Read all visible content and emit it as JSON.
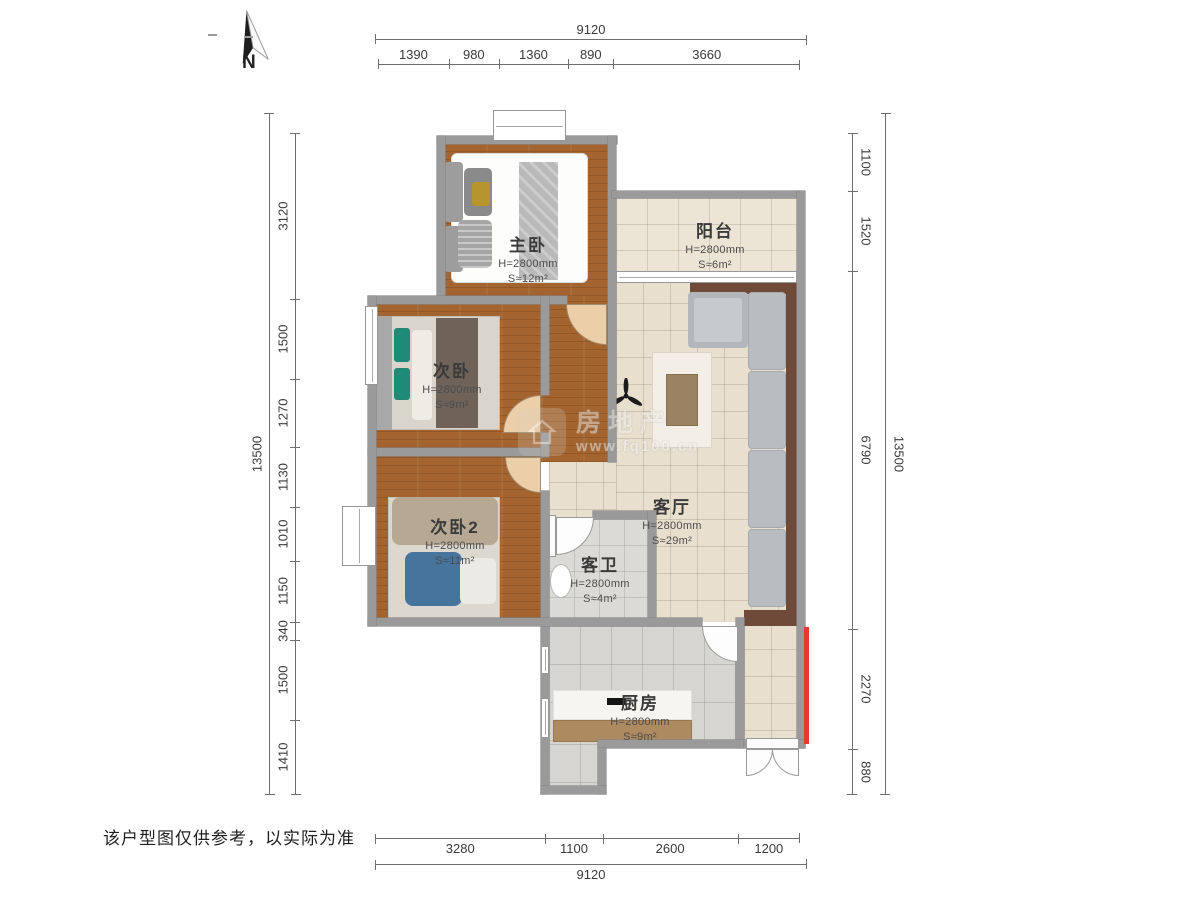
{
  "north": {
    "label": "N"
  },
  "disclaimer": "该户型图仅供参考，以实际为准",
  "watermark": {
    "brand": "房地产",
    "url": "www.fq100.cn",
    "icon": "house-icon"
  },
  "rooms": {
    "master": {
      "name": "主卧",
      "height": "H=2800mm",
      "area": "S≈12m²"
    },
    "bed2": {
      "name": "次卧",
      "height": "H=2800mm",
      "area": "S≈9m²"
    },
    "bed3": {
      "name": "次卧2",
      "height": "H=2800mm",
      "area": "S≈11m²"
    },
    "living": {
      "name": "客厅",
      "height": "H=2800mm",
      "area": "S≈29m²"
    },
    "balcony": {
      "name": "阳台",
      "height": "H=2800mm",
      "area": "S≈6m²"
    },
    "bath": {
      "name": "客卫",
      "height": "H=2800mm",
      "area": "S≈4m²"
    },
    "kitchen": {
      "name": "厨房",
      "height": "H=2800mm",
      "area": "S≈9m²"
    }
  },
  "dimensions": {
    "top_outer": [
      "9120"
    ],
    "top_inner": [
      "1390",
      "980",
      "1360",
      "890",
      "3660"
    ],
    "left_outer": [
      "13500"
    ],
    "left_inner": [
      "3120",
      "1500",
      "1270",
      "1130",
      "1010",
      "1150",
      "340",
      "1500",
      "1410"
    ],
    "right_outer": [
      "13500"
    ],
    "right_inner": [
      "1100",
      "1520",
      "6790",
      "2270",
      "880"
    ],
    "bottom_inner": [
      "3280",
      "1100",
      "2600",
      "1200"
    ],
    "bottom_outer": [
      "9120"
    ]
  },
  "colors": {
    "wall": "#9a9a9a",
    "wood_floor": "#a4642f",
    "tile_floor": "#e8dfcf",
    "accent_red": "#e23b30"
  }
}
